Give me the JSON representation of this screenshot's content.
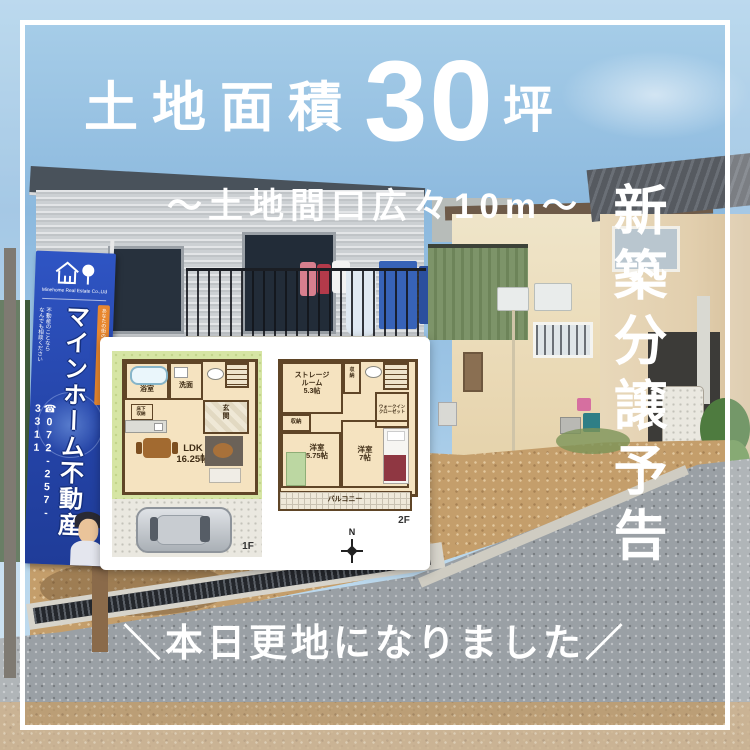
{
  "overlay": {
    "title_prefix": "土地面積",
    "title_number": "30",
    "title_unit": "坪",
    "subtitle": "～土地間口広々10m～",
    "side_vertical": "新築分譲予告",
    "bottom_text": "＼本日更地になりました／"
  },
  "banner": {
    "logo_company_en": "Minehome Real Estate Co.,Ltd",
    "main_text": "マインホーム不動産",
    "phone_icon": "☎",
    "phone": "072-257-3311",
    "tagline_left": "不動産のことなら\nなんでも相談ください",
    "tagline_right": "あなたの街の不動産屋さん"
  },
  "floorplan": {
    "floor1": {
      "bath": "浴室",
      "wash": "洗面",
      "entrance": "玄\n関",
      "underfloor": "床下\n収納",
      "ldk": "LDK\n16.25帖",
      "label": "1F"
    },
    "floor2": {
      "storage_room": "ストレージ\nルーム\n5.3帖",
      "closet_top": "収\n納",
      "closet_left": "収納",
      "wic": "ウォークイン\nクローゼット",
      "bedroom1": "洋室\n5.75帖",
      "bedroom2": "洋室\n7帖",
      "balcony": "バルコニー",
      "label": "2F"
    },
    "compass_n": "N"
  },
  "colors": {
    "banner_blue": "#2443a6",
    "frame_white": "#ffffff",
    "sky_blue": "#8cb9de",
    "dirt_tan": "#c49e6b",
    "road_gray": "#9aa0a5",
    "plan_wall_brown": "#5f4527",
    "plan_floor_tan": "#f5e3c0",
    "lawn_green": "#d6e5a4",
    "accent_orange": "#e8872f"
  }
}
